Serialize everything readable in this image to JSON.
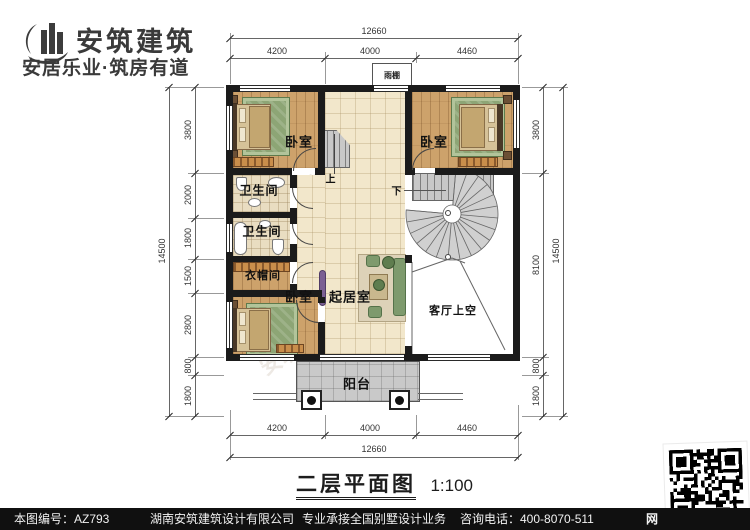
{
  "logo": {
    "brand": "安筑建筑",
    "tagline": "安居乐业·筑房有道"
  },
  "title": {
    "name": "二层平面图",
    "scale": "1:100"
  },
  "footer": {
    "sheet_no": "本图编号：AZ793",
    "company": "湖南安筑建筑设计有限公司",
    "service": "专业承接全国别墅设计业务",
    "hotline": "咨询电话：400-8070-511",
    "web": "网"
  },
  "rooms": {
    "bedroom_tl": "卧室",
    "bedroom_tr": "卧室",
    "bedroom_bl": "卧室",
    "bath_upper": "卫生间",
    "bath_lower": "卫生间",
    "cloak": "衣帽间",
    "living": "起居室",
    "void": "客厅上空",
    "balcony": "阳台",
    "canopy": "雨棚",
    "stair_up": "上",
    "stair_down": "下"
  },
  "dims": {
    "top": {
      "total": "12660",
      "segments": [
        "4200",
        "4000",
        "4460"
      ]
    },
    "bottom": {
      "total": "12660",
      "segments": [
        "4200",
        "4000",
        "4460"
      ]
    },
    "left": {
      "total": "14500",
      "segments": [
        "3800",
        "2000",
        "1800",
        "1500",
        "2800",
        "800",
        "1800"
      ]
    },
    "right": {
      "total": "14500",
      "segments": [
        "3800",
        "8100",
        "800",
        "1800"
      ]
    }
  },
  "watermarks": [
    "安筑建筑",
    "安筑建筑",
    "安筑建筑",
    "hmaz"
  ]
}
